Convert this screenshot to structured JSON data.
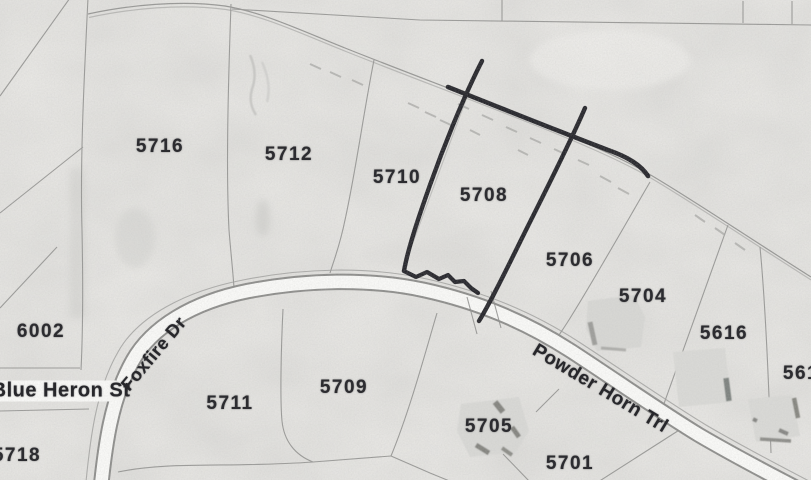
{
  "map": {
    "title": "Subdivision parcel plat (scanned)",
    "colors": {
      "paper": "#e9e8e5",
      "parcel_line": "#8d8d8b",
      "road_fill": "#f9f9f7",
      "label_text": "#2c2c30",
      "highlight_annotation": "#1f1f24"
    },
    "annotation": {
      "type": "hand-drawn highlight",
      "target_parcel": "5708",
      "color": "#1f1f24"
    },
    "parcel_labels": [
      {
        "id": "5716",
        "text": "5716",
        "x": 160,
        "y": 147
      },
      {
        "id": "5712",
        "text": "5712",
        "x": 289,
        "y": 155
      },
      {
        "id": "5710",
        "text": "5710",
        "x": 397,
        "y": 178
      },
      {
        "id": "5708",
        "text": "5708",
        "x": 484,
        "y": 196
      },
      {
        "id": "5706",
        "text": "5706",
        "x": 570,
        "y": 261
      },
      {
        "id": "5704",
        "text": "5704",
        "x": 643,
        "y": 297
      },
      {
        "id": "5616",
        "text": "5616",
        "x": 724,
        "y": 334
      },
      {
        "id": "561",
        "text": "561",
        "x": 801,
        "y": 374
      },
      {
        "id": "6002",
        "text": "6002",
        "x": 41,
        "y": 332
      },
      {
        "id": "5711",
        "text": "5711",
        "x": 230,
        "y": 404
      },
      {
        "id": "5709",
        "text": "5709",
        "x": 344,
        "y": 388
      },
      {
        "id": "5705",
        "text": "5705",
        "x": 489,
        "y": 427
      },
      {
        "id": "5701",
        "text": "5701",
        "x": 570,
        "y": 464
      },
      {
        "id": "5718",
        "text": "5718",
        "x": 17,
        "y": 456
      }
    ],
    "street_labels": [
      {
        "id": "foxfire-dr",
        "text": "Foxfire Dr",
        "x": 154,
        "y": 354,
        "rotate": -50,
        "size": 18
      },
      {
        "id": "blue-heron-st",
        "text": "Blue Heron St",
        "x": 61,
        "y": 391,
        "rotate": 0,
        "size": 20
      },
      {
        "id": "powder-horn-trl",
        "text": "Powder Horn Trl",
        "x": 600,
        "y": 389,
        "rotate": 31,
        "size": 19
      }
    ]
  }
}
